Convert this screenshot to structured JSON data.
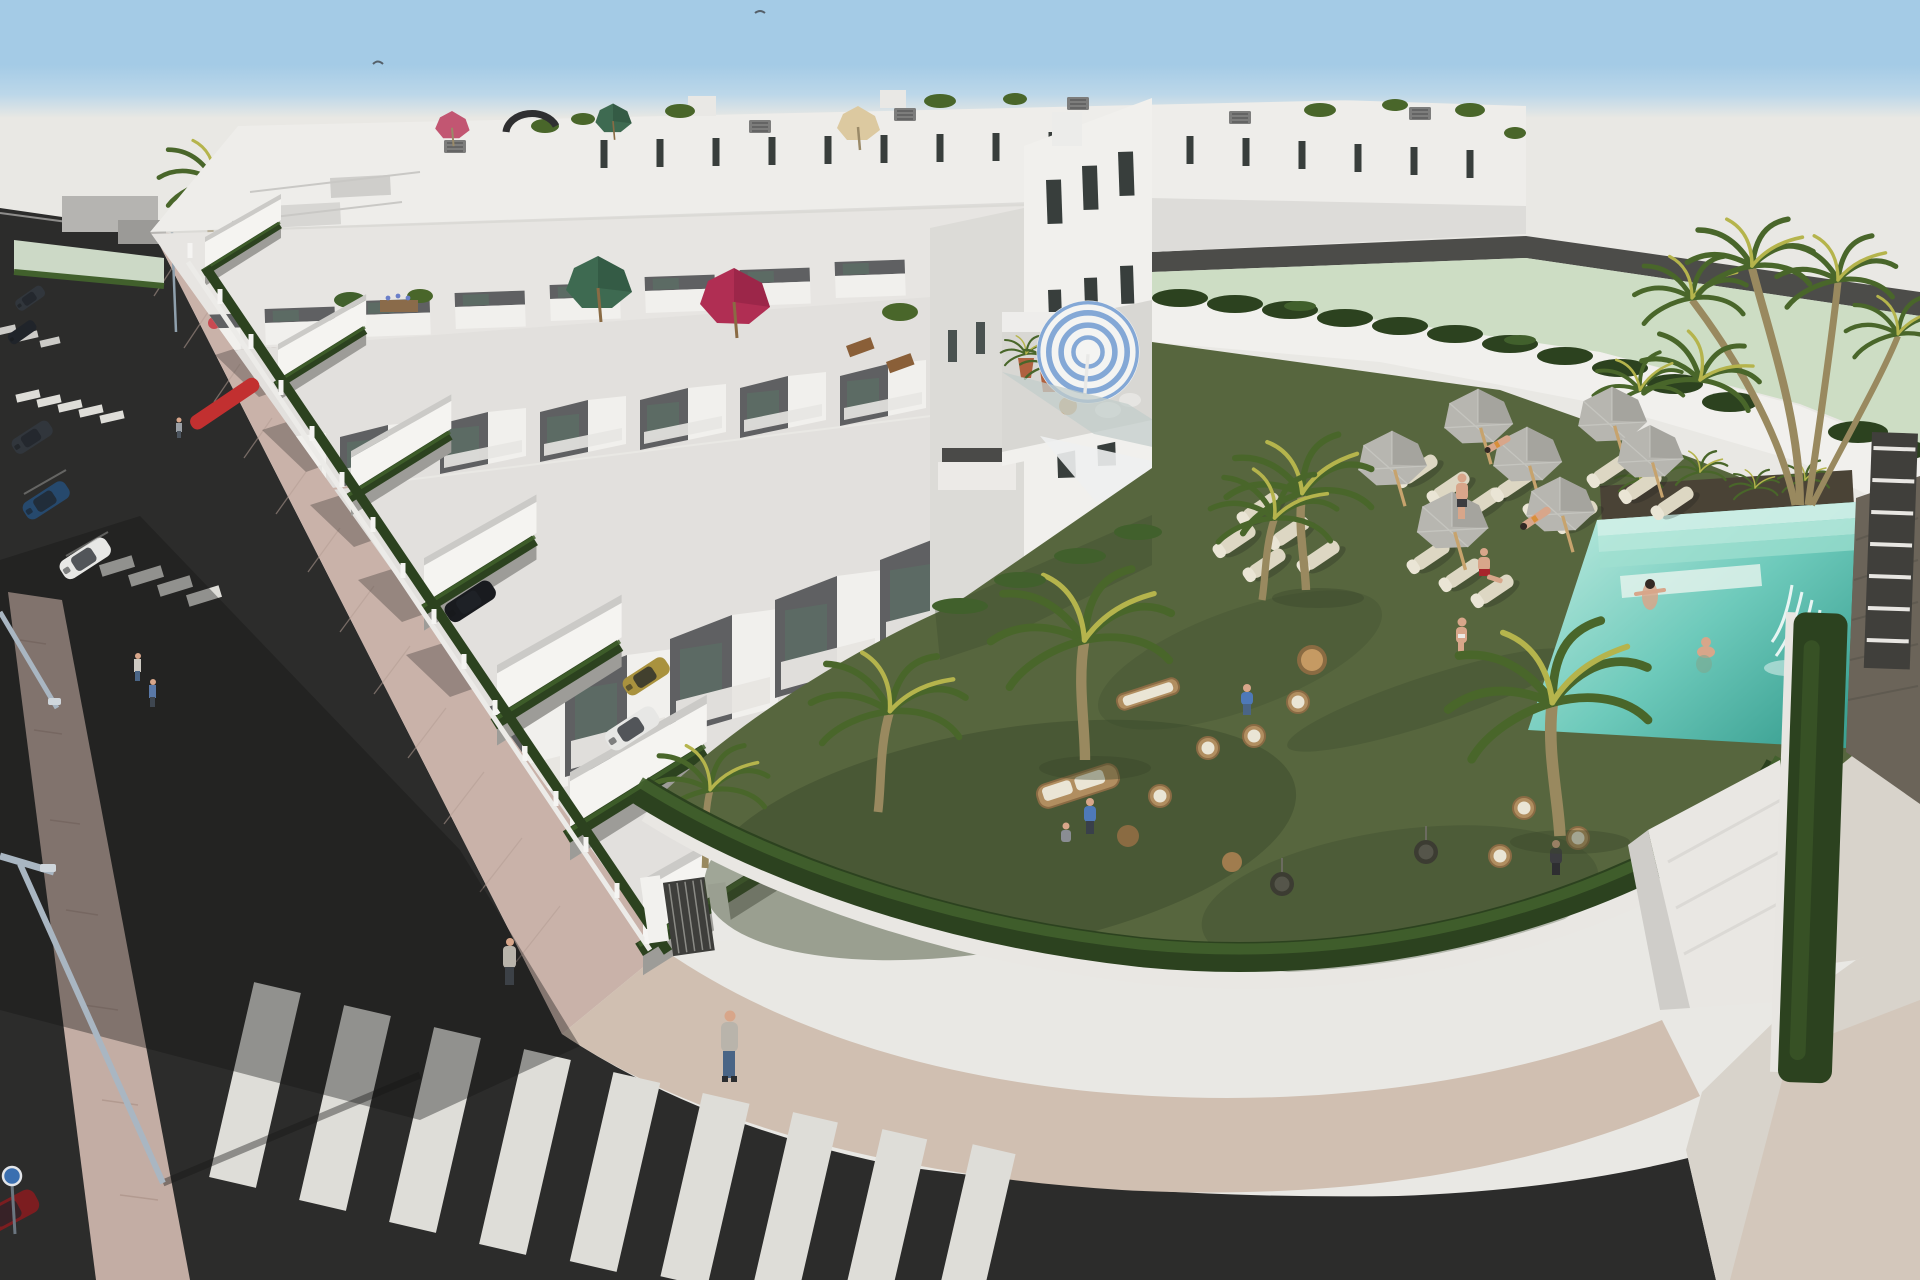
{
  "meta": {
    "domain": "natural-image",
    "subject": "Aerial 3D architectural rendering of a modern white townhouse development on a street corner, with rooftop terraces, hedge-walled driveways, and a communal pool garden with sun loungers and palm trees",
    "visible_text": "none"
  },
  "colors": {
    "sky_top": "#a4cbe6",
    "sky_fade": "#d9e5ec",
    "haze": "#e9e8e4",
    "field_green": "#cdddc4",
    "road_strip": "#4c4c49",
    "asphalt": "#2c2c2b",
    "median_paver": "#c3ada4",
    "sidewalk_paver": "#c9b2a9",
    "pavement_light": "#d8d3cb",
    "pavement_corner": "#d0bfb1",
    "crosswalk_white": "#deddd8",
    "building_white": "#f1f0ed",
    "building_cream": "#e7e5e2",
    "building_shade": "#cfcecb",
    "building_band": "#e2e0dd",
    "panel_gray": "#5f6062",
    "terrace_floor": "#d8d7d3",
    "window_glass": "#5c6b64",
    "window_dark": "#383e3c",
    "hedge_dark": "#2c421f",
    "hedge_mid": "#41602c",
    "hedge_light": "#628441",
    "lawn": "#57663e",
    "lawn_dark": "#39462a",
    "pool_light": "#aee4d8",
    "pool_mid": "#6ecabb",
    "pool_deep": "#3da294",
    "pool_step": "#cdeee6",
    "stone_wall": "#6b6459",
    "slat_dark": "#403f3b",
    "palm_trunk": "#99895f",
    "frond": "#49662a",
    "frond_light": "#b5b44c",
    "umb_gray": "#b7b6b0",
    "umb_gray_shade": "#97968f",
    "umb_green": "#3e6a51",
    "umb_crimson": "#b02e53",
    "umb_pink": "#c25672",
    "umb_tan": "#dcc9a0",
    "umb_stripe_blue": "#84a8d6",
    "lounger_cream": "#ddd7c3",
    "wicker": "#b18e60",
    "cushion_cream": "#eae5d5",
    "skin": "#d8a68a",
    "canopy_glass": "#c3cecb",
    "sail_white": "#eef0f0",
    "car_dark": "#31363c",
    "car_navy": "#26496d",
    "car_white": "#e7e7e5",
    "car_black": "#191b1f",
    "car_gold": "#a9923e",
    "car_red": "#7c1d20",
    "accent_red": "#c23030",
    "pole_gray": "#a9b6c2",
    "sign_blue": "#3a6fb0",
    "shadow": "#161615",
    "hoodie_gray": "#b9b4ab",
    "jeans_blue": "#4a6586",
    "shirt_blue": "#4e79b8",
    "shorts_red": "#a8252b",
    "bikini_orange": "#d88f3a",
    "hair_dark": "#332a24",
    "shirt_dark": "#3c3c40"
  },
  "scene": {
    "sky": {
      "birds": 2
    },
    "buildings": {
      "rows_of_townhouses": 4,
      "material": "white render, flat roofs",
      "roof_terraces": true,
      "rooftop_umbrellas": [
        "pink",
        "green small",
        "tan",
        "green large",
        "crimson",
        "blue-white striped"
      ],
      "slot_windows": true,
      "ac_units_on_roof": 6
    },
    "street": {
      "crosswalks": 3,
      "streetlights": 3,
      "traffic_sign": "blue circular",
      "parked_cars": [
        "dark gray",
        "graphite",
        "dark suv",
        "navy blue",
        "white",
        "dark red"
      ],
      "pedestrians": 5,
      "median_strip": true
    },
    "driveways": {
      "cars": [
        "black suv",
        "gold",
        "white hatchback"
      ],
      "hedge_gardens": 7,
      "fence_posts": 16,
      "entrance_gate": true,
      "red_awning": 1
    },
    "pool_garden": {
      "lawn": "olive green",
      "gray_sun_umbrellas": 7,
      "sun_loungers": 17,
      "wicker_chairs": 7,
      "egg_swings": 2,
      "palm_trees": 12,
      "wicker_sofa": 1,
      "stump_tables": 3,
      "pool": {
        "swimmers": 2,
        "steps": true,
        "waterfall": true,
        "stone_feature_wall": true,
        "white_slat_wall": true
      },
      "people_on_lawn": 9,
      "glass_canopy": true,
      "shade_sail": true,
      "stairs": true
    }
  }
}
